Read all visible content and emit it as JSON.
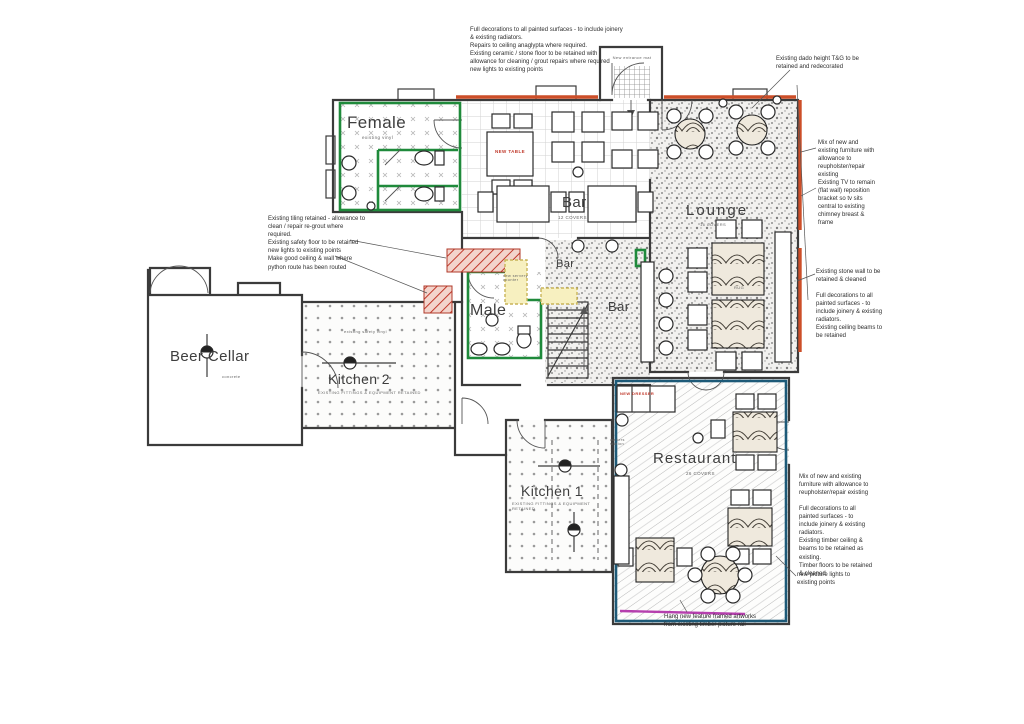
{
  "colors": {
    "green": "#1f8a3b",
    "orange": "#cc4e28",
    "blue": "#1d5a78",
    "red": "#c0392b",
    "magenta": "#b53fae",
    "yellowFill": "#f7f0c0",
    "yellowBorder": "#c9b458",
    "wall": "#3b3b3b"
  },
  "rooms": {
    "female": {
      "label": "Female",
      "sub": "existing vinyl"
    },
    "male": {
      "label": "Male"
    },
    "bar": {
      "label": "Bar",
      "covers": "12 COVERS"
    },
    "bar_servery": {
      "label": "Bar"
    },
    "bar_lower": {
      "label": "Bar"
    },
    "lounge": {
      "label": "Lounge",
      "covers": "16 COVERS"
    },
    "beer_cellar": {
      "label": "Beer Cellar",
      "sub": "concrete"
    },
    "kitchen2": {
      "label": "Kitchen 2",
      "sub": "EXISTING FITTINGS & EQUIPMENT RETAINED",
      "floor": "existing safety vinyl"
    },
    "kitchen1": {
      "label": "Kitchen 1",
      "sub": "EXISTING FITTINGS & EQUIPMENT RETAINED"
    },
    "restaurant": {
      "label": "Restaurant",
      "covers": "26 COVERS"
    }
  },
  "features": {
    "new_table": "NEW TABLE",
    "new_dresser": "NEW DRESSER",
    "entrance_mat": "New entrance mat",
    "rug": "RUG",
    "servery_counter": "new servery counter",
    "waiter_station": "waiters station"
  },
  "annotations": {
    "top": "Full decorations to all painted surfaces - to include joinery & existing radiators.\nRepairs to ceiling anaglypta where required.\nExisting ceramic / stone floor to be retained with allowance for cleaning / grout repairs where required\nnew lights to existing points",
    "dado": "Existing dado height T&G to be retained and redecorated",
    "lounge_furniture": "Mix of new and existing furniture with allowance to reupholster/repair existing",
    "tv": "Existing TV to remain (flat wall) reposition bracket so tv sits central to existing chimney breast & frame",
    "stone_wall": "Existing stone wall to be retained & cleaned",
    "lounge_dec": "Full decorations to all painted surfaces - to include joinery & existing radiators.\nExisting ceiling beams to be retained",
    "tiling": "Existing tiling retained - allowance to clean / repair re-grout where required.\nExisting safety floor to be retained\nnew lights to existing points\nMake good ceiling & wall where python route has been routed",
    "restaurant_furniture": "Mix of new and existing furniture with allowance to reupholster/repair existing",
    "restaurant_dec": "Full decorations to all painted surfaces - to include joinery & existing radiators.\nExisting timber ceiling & beams to be retained as existing.\nTimber floors to be retained & cleaned",
    "picture_lights": "new picture lights to existing points",
    "artwork": "Hang new feature framed artworks from existing timber picture rail"
  }
}
